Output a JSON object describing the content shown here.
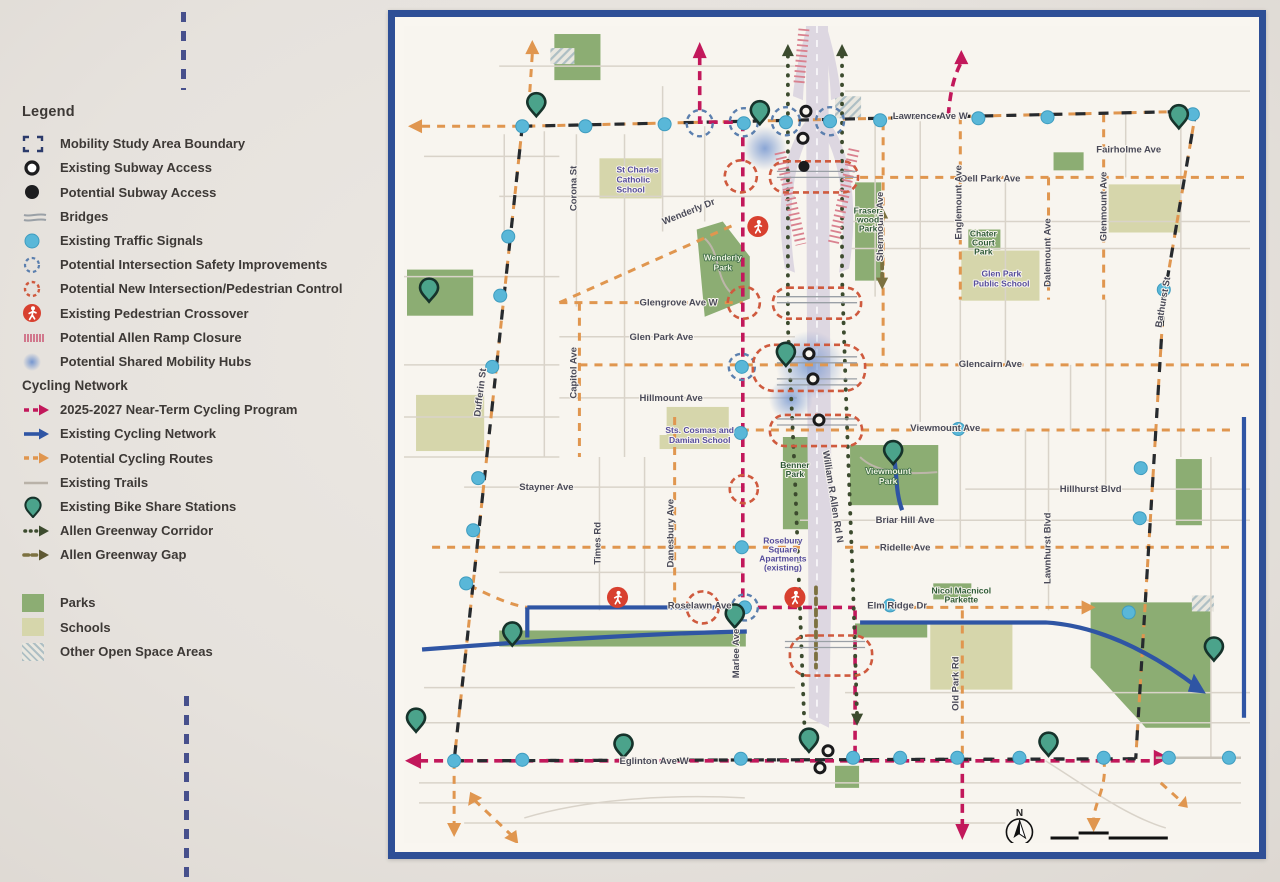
{
  "legend": {
    "title": "Legend",
    "items": [
      {
        "label": "Mobility Study Area Boundary",
        "icon": "boundary-corners-icon"
      },
      {
        "label": "Existing Subway Access",
        "icon": "open-circle-icon"
      },
      {
        "label": "Potential Subway Access",
        "icon": "filled-circle-icon"
      },
      {
        "label": "Bridges",
        "icon": "bridge-lines-icon"
      },
      {
        "label": "Existing Traffic Signals",
        "icon": "traffic-signal-dot-icon"
      },
      {
        "label": "Potential Intersection Safety Improvements",
        "icon": "blue-dashed-circle-icon"
      },
      {
        "label": "Potential New Intersection/Pedestrian Control",
        "icon": "red-dashed-circle-icon"
      },
      {
        "label": "Existing Pedestrian Crossover",
        "icon": "pedestrian-crossover-icon"
      },
      {
        "label": "Potential Allen Ramp Closure",
        "icon": "pink-hatch-icon"
      },
      {
        "label": "Potential Shared Mobility Hubs",
        "icon": "blue-blur-icon"
      }
    ],
    "cycling_header": "Cycling Network",
    "cycling_items": [
      {
        "label": "2025-2027 Near-Term Cycling Program",
        "icon": "crimson-dashed-arrow-icon"
      },
      {
        "label": "Existing Cycling Network",
        "icon": "blue-arrow-icon"
      },
      {
        "label": "Potential Cycling Routes",
        "icon": "orange-dashed-arrow-icon"
      },
      {
        "label": "Existing Trails",
        "icon": "gray-line-icon"
      },
      {
        "label": "Existing Bike Share Stations",
        "icon": "bike-share-pin-icon"
      },
      {
        "label": "Allen Greenway Corridor",
        "icon": "olive-dotted-arrow-icon"
      },
      {
        "label": "Allen Greenway Gap",
        "icon": "olive-dashed-arrow-icon"
      }
    ],
    "area_items": [
      {
        "label": "Parks",
        "swatch": "#8cad73"
      },
      {
        "label": "Schools",
        "swatch": "#d6d6ab"
      },
      {
        "label": "Other Open Space Areas",
        "swatch": "hatch"
      }
    ]
  },
  "map": {
    "colors": {
      "frame": "#2e4f96",
      "near_term_cycling": "#c2185b",
      "existing_cycling": "#2f55a4",
      "potential_route": "#e0964f",
      "traffic_signal": "#59b7d8",
      "safety_improvement": "#5b7fae",
      "new_intersection": "#cf5a3e",
      "pedestrian_crossover": "#d8402f",
      "ramp_closure": "#d97f98",
      "greenway_corridor": "#3c4b2e",
      "greenway_gap": "#7c7140",
      "park": "#8cad73",
      "school": "#d6d6ab",
      "bike_share_pin": "#4ba38b",
      "boundary": "#262a2e"
    },
    "labels": {
      "lawrence": "Lawrence Ave W",
      "fairholme": "Fairholme Ave",
      "dell_park": "Dell Park Ave",
      "shermount": "Shermount Ave",
      "englemount": "Englemount Ave",
      "dalemount": "Dalemount Ave",
      "glenmount": "Glenmount Ave",
      "bathurst": "Bathurst St",
      "corona": "Corona St",
      "st_charles_1": "St Charles",
      "st_charles_2": "Catholic",
      "st_charles_3": "School",
      "wenderly_dr": "Wenderly Dr",
      "wenderly_park_1": "Wenderly",
      "wenderly_park_2": "Park",
      "fraserwood_1": "Fraser-",
      "fraserwood_2": "wood",
      "fraserwood_3": "Park",
      "chater_1": "Chater",
      "chater_2": "Court",
      "chater_3": "Park",
      "glen_park_school_1": "Glen Park",
      "glen_park_school_2": "Public School",
      "glengrove": "Glengrove Ave W",
      "glen_park_ave": "Glen Park Ave",
      "capitol": "Capitol Ave",
      "hillmount": "Hillmount Ave",
      "glencairn": "Glencairn Ave",
      "sts_cosmas_1": "Sts. Cosmas and",
      "sts_cosmas_2": "Damian School",
      "viewmount_ave": "Viewmount Ave",
      "benner_1": "Benner",
      "benner_2": "Park",
      "william_allen": "William R Allen Rd N",
      "viewmount_park_1": "Viewmount",
      "viewmount_park_2": "Park",
      "hillhurst": "Hillhurst Blvd",
      "briar_hill": "Briar Hill Ave",
      "ridelle": "Ridelle Ave",
      "lawnhurst": "Lawnhurst Blvd",
      "stayner": "Stayner Ave",
      "dufferin": "Dufferin St",
      "times": "Times Rd",
      "danesbury": "Danesbury Ave",
      "rosebury_1": "Rosebury",
      "rosebury_2": "Square",
      "rosebury_3": "Apartments",
      "rosebury_4": "(existing)",
      "roselawn": "Roselawn Ave",
      "elm_ridge": "Elm Ridge Dr",
      "nicol_1": "Nicol Macnicol",
      "nicol_2": "Parkette",
      "old_park": "Old Park Rd",
      "marlee": "Marlee Ave",
      "eglinton": "Eglinton Ave W"
    },
    "scale": {
      "north": "N",
      "t0": "0",
      "t100": "100",
      "t200": "200",
      "t400": "400 metres"
    }
  }
}
